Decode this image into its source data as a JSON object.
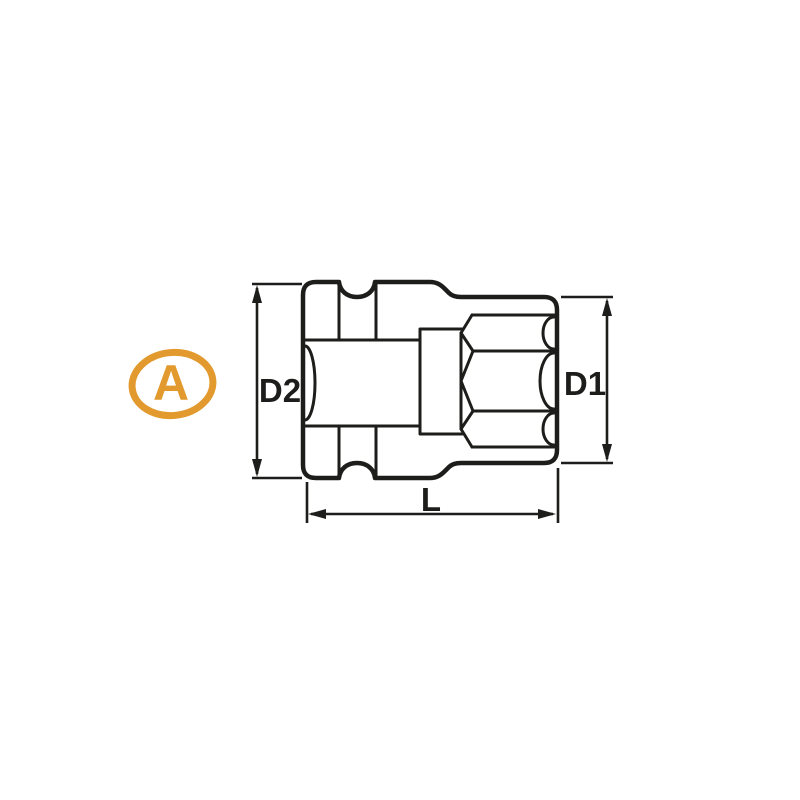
{
  "marker": {
    "label": "A"
  },
  "dimensions": {
    "d2": "D2",
    "d1": "D1",
    "length": "L"
  },
  "colors": {
    "accent": "#E29A2E",
    "line": "#1D1D1B",
    "background": "#FFFFFF"
  }
}
